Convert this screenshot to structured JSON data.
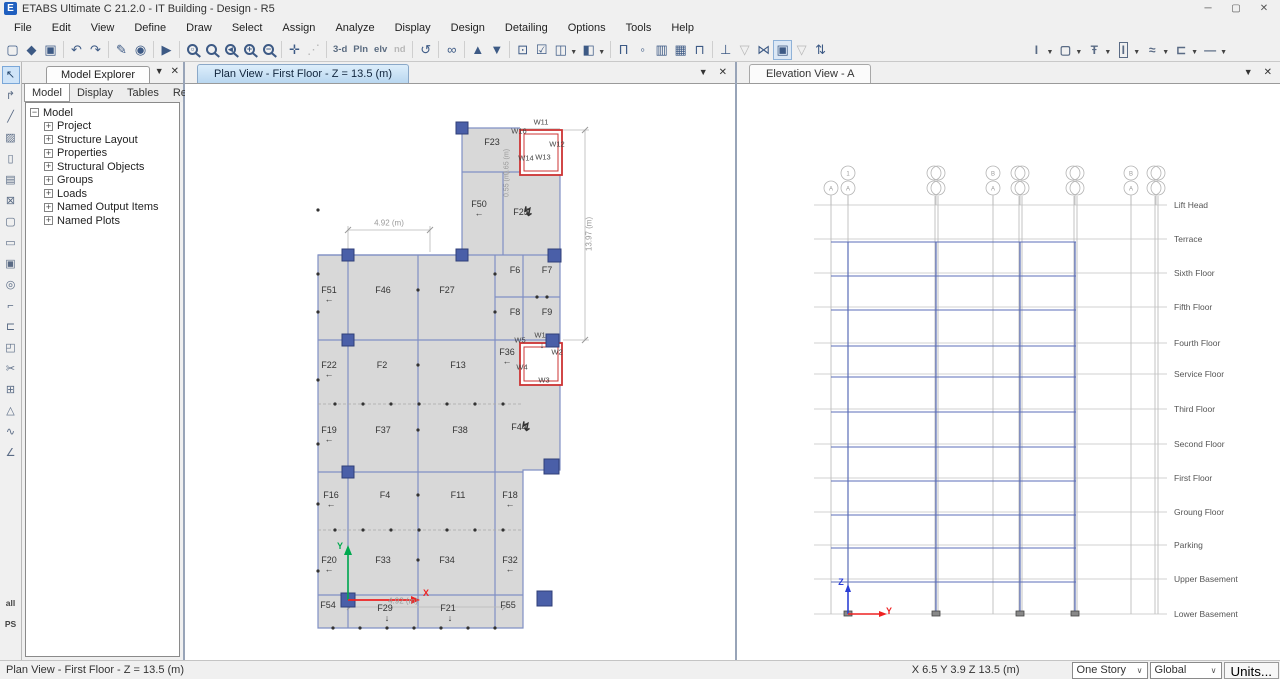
{
  "titlebar": {
    "title": "ETABS Ultimate C 21.2.0 - IT Building - Design - R5",
    "app_icon_letter": "E",
    "controls": [
      {
        "name": "minimize-icon",
        "glyph": "─"
      },
      {
        "name": "maximize-icon",
        "glyph": "▢"
      },
      {
        "name": "close-icon",
        "glyph": "✕"
      }
    ]
  },
  "menu": {
    "items": [
      "File",
      "Edit",
      "View",
      "Define",
      "Draw",
      "Select",
      "Assign",
      "Analyze",
      "Display",
      "Design",
      "Detailing",
      "Options",
      "Tools",
      "Help"
    ]
  },
  "toolbar": {
    "groups": [
      {
        "icons": [
          {
            "n": "new-model-icon",
            "g": "▢"
          },
          {
            "n": "open-model-icon",
            "g": "◆"
          },
          {
            "n": "save-model-icon",
            "g": "▣"
          }
        ]
      },
      {
        "icons": [
          {
            "n": "undo-icon",
            "g": "↶"
          },
          {
            "n": "redo-icon",
            "g": "↷"
          }
        ]
      },
      {
        "icons": [
          {
            "n": "edit-icon",
            "g": "✎"
          },
          {
            "n": "lock-model-icon",
            "g": "◉"
          }
        ]
      },
      {
        "icons": [
          {
            "n": "run-analysis-icon",
            "g": "▶"
          }
        ]
      },
      {
        "icons": [
          {
            "n": "rubber-band-zoom-icon",
            "m": "▫"
          },
          {
            "n": "restore-full-view-icon",
            "m": ""
          },
          {
            "n": "previous-zoom-icon",
            "m": "◂"
          },
          {
            "n": "zoom-in-icon",
            "m": "+"
          },
          {
            "n": "zoom-out-icon",
            "m": "−"
          }
        ]
      },
      {
        "icons": [
          {
            "n": "pan-icon",
            "g": "✛"
          },
          {
            "n": "measure-icon",
            "g": "⋰",
            "dim": 1
          }
        ]
      },
      {
        "icons": [
          {
            "n": "3d-view-icon",
            "t": "3-d"
          },
          {
            "n": "plan-view-icon",
            "t": "Pln"
          },
          {
            "n": "elevation-view-icon",
            "t": "elv"
          },
          {
            "n": "named-display-icon",
            "t": "nd",
            "dim": 1
          }
        ]
      },
      {
        "icons": [
          {
            "n": "rotate-3d-view-icon",
            "g": "↺"
          }
        ]
      },
      {
        "icons": [
          {
            "n": "perspective-toggle-icon",
            "g": "∞"
          }
        ]
      },
      {
        "icons": [
          {
            "n": "move-up-in-list-icon",
            "g": "▲"
          },
          {
            "n": "move-down-in-list-icon",
            "g": "▼"
          }
        ]
      },
      {
        "icons": [
          {
            "n": "shrink-objects-icon",
            "g": "⊡"
          },
          {
            "n": "show-selection-icon",
            "g": "☑"
          },
          {
            "n": "object-view-options-icon",
            "g": "◫",
            "dd": 1
          },
          {
            "n": "extruded-view-icon",
            "g": "◧",
            "dd": 1
          }
        ]
      },
      {
        "icons": [
          {
            "n": "draw-frame-icon",
            "g": "Π"
          },
          {
            "n": "snap-to-point-icon",
            "g": "◦"
          },
          {
            "n": "draw-wall-icon",
            "g": "▥"
          },
          {
            "n": "quick-draw-wall-icon",
            "g": "▦"
          },
          {
            "n": "draw-support-icon",
            "g": "⊓"
          }
        ]
      },
      {
        "icons": [
          {
            "n": "assign-support-icon",
            "g": "⊥"
          },
          {
            "n": "assign-diaphragm-icon",
            "g": "▽",
            "dim": 1
          },
          {
            "n": "assign-pier-icon",
            "g": "⋈"
          },
          {
            "n": "display-options-icon",
            "g": "▣",
            "pressed": 1
          },
          {
            "n": "assign-spandrel-icon",
            "g": "▽",
            "dim": 1
          },
          {
            "n": "reorder-icon",
            "g": "⇅"
          }
        ]
      }
    ],
    "right_tools": [
      {
        "n": "frame-property-icon",
        "g": "I"
      },
      {
        "n": "slab-property-icon",
        "g": "▢"
      },
      {
        "n": "tendon-property-icon",
        "g": "Ŧ"
      },
      {
        "n": "wall-property-icon",
        "g": "I",
        "boxed": 1
      },
      {
        "n": "rebar-property-icon",
        "g": "≈"
      },
      {
        "n": "steel-joist-property-icon",
        "g": "⊏"
      },
      {
        "n": "link-property-icon",
        "g": "—"
      }
    ]
  },
  "left_toolbar": {
    "icons": [
      {
        "n": "select-pointer-icon",
        "g": "↖",
        "sel": 1
      },
      {
        "n": "reshape-object-icon",
        "g": "↱"
      },
      {
        "n": "draw-joint-icon",
        "g": "╱"
      },
      {
        "n": "draw-frame-icon",
        "g": "▨"
      },
      {
        "n": "quick-draw-frame-icon",
        "g": "▯"
      },
      {
        "n": "quick-draw-secondary-beams-icon",
        "g": "▤"
      },
      {
        "n": "quick-draw-braces-icon",
        "g": "⊠"
      },
      {
        "n": "draw-floor-icon",
        "g": "▢"
      },
      {
        "n": "draw-rect-floor-icon",
        "g": "▭"
      },
      {
        "n": "quick-draw-floor-icon",
        "g": "▣"
      },
      {
        "n": "draw-wall-icon",
        "g": "◎"
      },
      {
        "n": "quick-draw-wall-icon",
        "g": "⌐"
      },
      {
        "n": "draw-wall-stack-icon",
        "g": "⊏"
      },
      {
        "n": "draw-opening-icon",
        "g": "◰"
      },
      {
        "n": "draw-section-cut-icon",
        "g": "✂"
      },
      {
        "n": "draw-grid-icon",
        "g": "⊞"
      },
      {
        "n": "draw-ramp-icon",
        "g": "△"
      },
      {
        "n": "draw-dimension-icon",
        "g": "∿"
      },
      {
        "n": "draw-reference-line-icon",
        "g": "∠"
      },
      {
        "n": "select-all-icon",
        "t": "all"
      },
      {
        "n": "previous-selection-icon",
        "t": "PS"
      }
    ]
  },
  "explorer": {
    "title": "Model Explorer",
    "tabs": [
      "Model",
      "Display",
      "Tables",
      "Reports"
    ],
    "active_tab": "Model",
    "tree_root": "Model",
    "tree_items": [
      "Project",
      "Structure Layout",
      "Properties",
      "Structural Objects",
      "Groups",
      "Loads",
      "Named Output Items",
      "Named Plots"
    ]
  },
  "plan": {
    "tab": "Plan View - First Floor - Z = 13.5 (m)",
    "labels": [
      {
        "t": "F23",
        "x": 307,
        "y": 58
      },
      {
        "t": "W16",
        "x": 334,
        "y": 47,
        "s": 1
      },
      {
        "t": "W11",
        "x": 356,
        "y": 38,
        "s": 1
      },
      {
        "t": "W12",
        "x": 372,
        "y": 60,
        "s": 1
      },
      {
        "t": "W14",
        "x": 341,
        "y": 74,
        "s": 1
      },
      {
        "t": "W13",
        "x": 358,
        "y": 73,
        "s": 1
      },
      {
        "t": "F50",
        "x": 294,
        "y": 120,
        "a": "l"
      },
      {
        "t": "F25",
        "x": 336,
        "y": 128,
        "a": "z"
      },
      {
        "t": "F51",
        "x": 144,
        "y": 206,
        "a": "l"
      },
      {
        "t": "F46",
        "x": 198,
        "y": 206
      },
      {
        "t": "F27",
        "x": 262,
        "y": 206
      },
      {
        "t": "F6",
        "x": 330,
        "y": 186
      },
      {
        "t": "F7",
        "x": 362,
        "y": 186
      },
      {
        "t": "F8",
        "x": 330,
        "y": 228
      },
      {
        "t": "F9",
        "x": 362,
        "y": 228
      },
      {
        "t": "F22",
        "x": 144,
        "y": 281,
        "a": "l"
      },
      {
        "t": "F2",
        "x": 197,
        "y": 281
      },
      {
        "t": "F13",
        "x": 273,
        "y": 281
      },
      {
        "t": "F36",
        "x": 322,
        "y": 268,
        "a": "l"
      },
      {
        "t": "W5",
        "x": 335,
        "y": 256,
        "s": 1
      },
      {
        "t": "W1",
        "x": 355,
        "y": 251,
        "s": 1,
        "a": "d"
      },
      {
        "t": "W2",
        "x": 372,
        "y": 268,
        "s": 1
      },
      {
        "t": "W4",
        "x": 337,
        "y": 283,
        "s": 1
      },
      {
        "t": "W3",
        "x": 359,
        "y": 296,
        "s": 1
      },
      {
        "t": "F19",
        "x": 144,
        "y": 346,
        "a": "l"
      },
      {
        "t": "F37",
        "x": 198,
        "y": 346
      },
      {
        "t": "F38",
        "x": 275,
        "y": 346
      },
      {
        "t": "F44",
        "x": 334,
        "y": 343,
        "a": "z"
      },
      {
        "t": "F16",
        "x": 146,
        "y": 411,
        "a": "l"
      },
      {
        "t": "F4",
        "x": 200,
        "y": 411
      },
      {
        "t": "F11",
        "x": 273,
        "y": 411
      },
      {
        "t": "F18",
        "x": 325,
        "y": 411,
        "a": "l"
      },
      {
        "t": "F20",
        "x": 144,
        "y": 476,
        "a": "l"
      },
      {
        "t": "F33",
        "x": 198,
        "y": 476
      },
      {
        "t": "F34",
        "x": 262,
        "y": 476
      },
      {
        "t": "F32",
        "x": 325,
        "y": 476,
        "a": "l"
      },
      {
        "t": "F54",
        "x": 143,
        "y": 521
      },
      {
        "t": "F29",
        "x": 200,
        "y": 524,
        "a": "d"
      },
      {
        "t": "F21",
        "x": 263,
        "y": 524,
        "a": "d"
      },
      {
        "t": "F55",
        "x": 323,
        "y": 521
      }
    ],
    "dims": [
      {
        "t": "4.92 (m)",
        "x": 204,
        "y": 139
      },
      {
        "t": "13.97 (m)",
        "x": 404,
        "y": 150,
        "r": 1
      },
      {
        "t": "0.65 (m)",
        "x": 322,
        "y": 78,
        "r": 1,
        "sm": 1
      },
      {
        "t": "0.55 (m)",
        "x": 322,
        "y": 100,
        "r": 1,
        "sm": 1
      },
      {
        "t": "4.92 (m)",
        "x": 218,
        "y": 517
      }
    ],
    "axis": {
      "x_label": "X",
      "y_label": "Y"
    }
  },
  "elevation": {
    "tab": "Elevation View - A",
    "stories": [
      {
        "name": "Lift Head",
        "y": 121
      },
      {
        "name": "Terrace",
        "y": 155
      },
      {
        "name": "Sixth Floor",
        "y": 189
      },
      {
        "name": "Fifth Floor",
        "y": 223
      },
      {
        "name": "Fourth Floor",
        "y": 259
      },
      {
        "name": "Service Floor",
        "y": 290
      },
      {
        "name": "Third Floor",
        "y": 325
      },
      {
        "name": "Second Floor",
        "y": 360
      },
      {
        "name": "First Floor",
        "y": 394
      },
      {
        "name": "Groung Floor",
        "y": 428
      },
      {
        "name": "Parking",
        "y": 461
      },
      {
        "name": "Upper Basement",
        "y": 495
      },
      {
        "name": "Lower Basement",
        "y": 530
      }
    ],
    "grid": [
      {
        "x": 94
      },
      {
        "x": 111
      },
      {
        "x": 199,
        "d": 1
      },
      {
        "x": 256
      },
      {
        "x": 283,
        "d": 1
      },
      {
        "x": 338,
        "d": 1
      },
      {
        "x": 394
      },
      {
        "x": 419,
        "d": 1
      }
    ],
    "bubbles": [
      {
        "x": 94,
        "b": "A"
      },
      {
        "x": 111,
        "t": "1",
        "b": "A"
      },
      {
        "x": 199,
        "d": 1
      },
      {
        "x": 256,
        "t": "B",
        "b": "A"
      },
      {
        "x": 283,
        "d": 1
      },
      {
        "x": 338,
        "d": 1
      },
      {
        "x": 394,
        "t": "B",
        "b": "A"
      },
      {
        "x": 419,
        "d": 1
      }
    ],
    "columns": [
      111,
      199,
      283,
      338
    ],
    "axis": {
      "z_label": "Z",
      "y_label": "Y"
    }
  },
  "status": {
    "left": "Plan View - First Floor - Z = 13.5 (m)",
    "coords": "X 6.5  Y 3.9  Z 13.5 (m)",
    "story": "One Story",
    "csys": "Global",
    "units": "Units..."
  },
  "colors": {
    "slab_fill": "#d8d8d8",
    "grid_blue": "#8090c4",
    "column_blue": "#4a5fa8",
    "wall_red": "#cc3333",
    "axis_x_red": "#ee2222",
    "axis_y_green": "#00a94f",
    "axis_z_blue": "#2b3fd6"
  }
}
